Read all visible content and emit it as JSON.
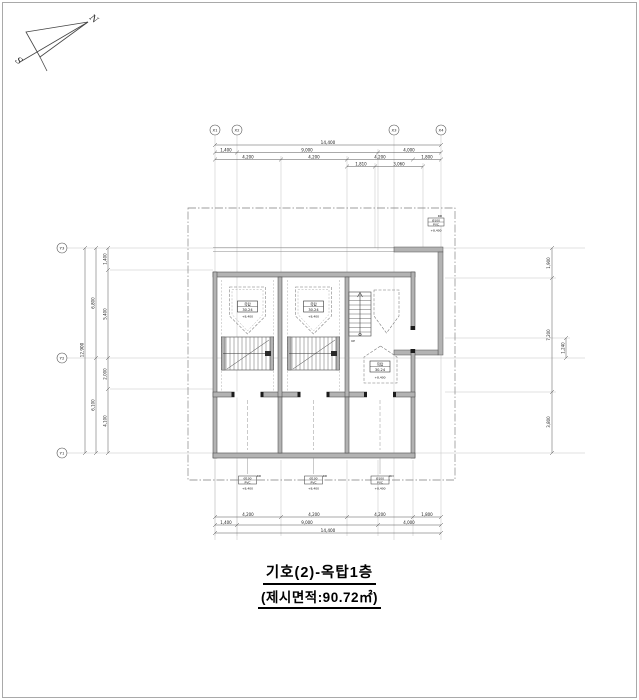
{
  "title": {
    "line1": "기호(2)-옥탑1층",
    "line2": "(제시면적:90.72㎡)"
  },
  "compass": {
    "north": "N",
    "south": "S"
  },
  "grid_bubbles": {
    "x": [
      "X1",
      "X2",
      "X3",
      "X4"
    ],
    "y": [
      "Y3",
      "Y2",
      "Y1"
    ]
  },
  "dimensions": {
    "top": {
      "total": "14,400",
      "row2": [
        "1,400",
        "9,000",
        "4,000"
      ],
      "row3": [
        "4,200",
        "4,200",
        "4,200",
        "1,800"
      ],
      "row4": [
        "1,810",
        "3,060"
      ]
    },
    "bottom": {
      "row1": [
        "4,200",
        "4,200",
        "4,200",
        "1,800"
      ],
      "row2": [
        "1,400",
        "9,000",
        "4,000"
      ],
      "total": "14,400"
    },
    "left": {
      "segments": [
        "1,400",
        "5,400",
        "2,000",
        "4,100"
      ],
      "halves": [
        "6,800",
        "6,100"
      ],
      "total": "12,900"
    },
    "right": {
      "segments": [
        "1,900",
        "7,200",
        "3,800"
      ],
      "offset": "1,240"
    }
  },
  "unit_tag": {
    "name": "옥탑",
    "area": "30.24",
    "level": "+8,400"
  },
  "stair": {
    "up_label": "UP"
  },
  "drain_tag": {
    "label": "RD",
    "size": "Ø100",
    "spec": "PVC",
    "level": "+8,400"
  }
}
